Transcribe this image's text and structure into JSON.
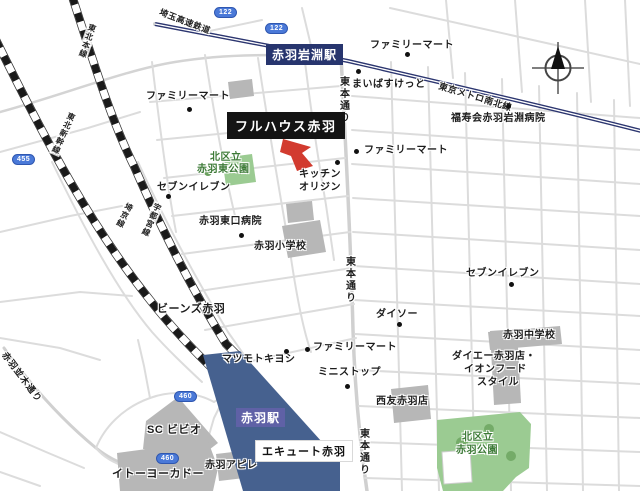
{
  "colors": {
    "station_fill": "#46618f",
    "callout_bg": "#141414",
    "marker_red": "#d23b2f",
    "park_green": "#9bcb92",
    "park_text_green": "#3c7a36",
    "metro_navy": "#2b3570",
    "station_badge_navy": "#27356e",
    "station_badge_indigo": "#5f61a6",
    "route_shield_blue": "#4a79d8",
    "road_gray": "#d9d9d9",
    "building_gray": "#b7b7b7"
  },
  "callout": {
    "label": "フルハウス赤羽"
  },
  "stations": {
    "iwabuchi": "赤羽岩淵駅",
    "akabane": "赤羽駅"
  },
  "railways": {
    "tohoku_shinkansen": "東北新幹線",
    "tohoku_main": "東北本線",
    "saikyo": "埼京線",
    "utsunomiya": "宇都宮線",
    "saitama_rapid": "埼玉高速鉄道",
    "metro_namboku": "東京メトロ南北線"
  },
  "roads": {
    "higashihon": "東本通り",
    "namiki": "赤羽並木通り"
  },
  "shields": {
    "r122a": "122",
    "r122b": "122",
    "r455": "455",
    "r460a": "460",
    "r460b": "460"
  },
  "pois": {
    "famima_nw": "ファミリーマート",
    "famima_ne": "ファミリーマート",
    "maibasuketto": "まいばすけっと",
    "fukujukai": "福寿会赤羽岩淵病院",
    "famima_e": "ファミリーマート",
    "kitchen_origin_1": "キッチン",
    "kitchen_origin_2": "オリジン",
    "seven_w": "セブンイレブン",
    "higashiguchi_hospital": "赤羽東口病院",
    "elementary": "赤羽小学校",
    "beans": "ビーンズ赤羽",
    "seven_e": "セブンイレブン",
    "daiso": "ダイソー",
    "junior_high": "赤羽中学校",
    "daiei_1": "ダイエー赤羽店・",
    "daiei_2": "イオンフード",
    "daiei_3": "スタイル",
    "famima_s": "ファミリーマート",
    "matsukiyo": "マツモトキヨシ",
    "ministop": "ミニストップ",
    "seiyu": "西友赤羽店",
    "bivio": "SC ビビオ",
    "itoyokado": "イトーヨーカドー",
    "apire": "赤羽アピレ",
    "ecute": "エキュート赤羽"
  },
  "parks": {
    "higashi_1": "北区立",
    "higashi_2": "赤羽東公園",
    "akabane_1": "北区立",
    "akabane_2": "赤羽公園"
  }
}
